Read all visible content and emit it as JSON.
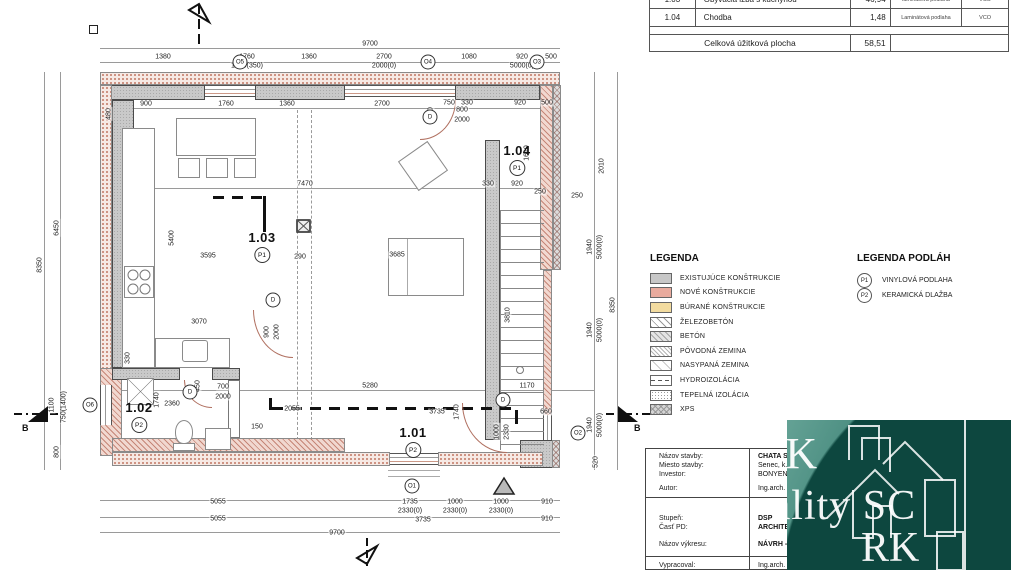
{
  "table": {
    "rows": [
      {
        "id": "1.03",
        "name": "Obývacia izba s kuchyňou",
        "area": "46,94",
        "floor": "laminátová podlaha",
        "code": "VCO"
      },
      {
        "id": "1.04",
        "name": "Chodba",
        "area": "1,48",
        "floor": "Laminátová podlaha",
        "code": "VCO"
      }
    ],
    "total_label": "Celková úžitková plocha",
    "total_value": "58,51"
  },
  "legend": {
    "title": "LEGENDA",
    "items": [
      {
        "label": "EXISTUJÚCE KONŠTRUKCIE"
      },
      {
        "label": "NOVÉ KONŠTRUKCIE"
      },
      {
        "label": "BÚRANÉ KONŠTRUKCIE"
      },
      {
        "label": "ŽELEZOBETÓN"
      },
      {
        "label": "BETÓN"
      },
      {
        "label": "PÔVODNÁ ZEMINA"
      },
      {
        "label": "NASYPANÁ ZEMINA"
      },
      {
        "label": "HYDROIZOLÁCIA"
      },
      {
        "label": "TEPELNÁ IZOLÁCIA"
      },
      {
        "label": "XPS"
      }
    ]
  },
  "floor_legend": {
    "title": "LEGENDA PODLÁH",
    "items": [
      {
        "tag": "P1",
        "label": "VINYLOVÁ PODLAHA"
      },
      {
        "tag": "P2",
        "label": "KERAMICKÁ DLAŽBA"
      }
    ]
  },
  "titleblock": {
    "rows": [
      {
        "label": "Názov stavby:",
        "value": "CHATA SE"
      },
      {
        "label": "Miesto stavby:",
        "value": "Senec, k.ú."
      },
      {
        "label": "Investor:",
        "value": "BONYEN,"
      },
      {
        "label": "Autor:",
        "value": "Ing.arch. K"
      },
      {
        "label": "Stupeň:",
        "value": "DSP"
      },
      {
        "label": "Časť PD:",
        "value": "ARCHITEK"
      },
      {
        "label": "Názov výkresu:",
        "value": "NÁVRH - P"
      },
      {
        "label": "Vypracoval:",
        "value": "Ing.arch. K"
      }
    ]
  },
  "watermark": {
    "lines": [
      "RK",
      "Reality SC",
      "RK"
    ],
    "teal_light": "#64a295",
    "teal_dark": "#124f47"
  },
  "plan": {
    "section_label": "B",
    "rooms": [
      {
        "id": "1.03",
        "tag": "P1",
        "x": 262,
        "y": 230
      },
      {
        "id": "1.04",
        "tag": "P1",
        "x": 517,
        "y": 143
      },
      {
        "id": "1.02",
        "tag": "P2",
        "x": 139,
        "y": 400
      },
      {
        "id": "1.01",
        "tag": "P2",
        "x": 413,
        "y": 425
      }
    ],
    "markers": [
      {
        "t": "O5",
        "x": 240,
        "y": 62
      },
      {
        "t": "O4",
        "x": 428,
        "y": 62
      },
      {
        "t": "O3",
        "x": 537,
        "y": 62
      },
      {
        "t": "O6",
        "x": 90,
        "y": 405
      },
      {
        "t": "O2",
        "x": 578,
        "y": 433
      },
      {
        "t": "O1",
        "x": 412,
        "y": 486
      },
      {
        "t": "D",
        "x": 430,
        "y": 117
      },
      {
        "t": "D",
        "x": 273,
        "y": 300
      },
      {
        "t": "D",
        "x": 190,
        "y": 392
      },
      {
        "t": "D",
        "x": 503,
        "y": 400
      }
    ],
    "dimensions": [
      {
        "t": "9700",
        "x": 370,
        "y": 44
      },
      {
        "t": "1380",
        "x": 163,
        "y": 57
      },
      {
        "t": "1760",
        "x": 247,
        "y": 57
      },
      {
        "t": "1650(350)",
        "x": 247,
        "y": 66
      },
      {
        "t": "1360",
        "x": 309,
        "y": 57
      },
      {
        "t": "2700",
        "x": 384,
        "y": 57
      },
      {
        "t": "2000(0)",
        "x": 384,
        "y": 66
      },
      {
        "t": "1080",
        "x": 469,
        "y": 57
      },
      {
        "t": "920",
        "x": 522,
        "y": 57
      },
      {
        "t": "5000(0)",
        "x": 522,
        "y": 66
      },
      {
        "t": "500",
        "x": 551,
        "y": 57
      },
      {
        "t": "480",
        "x": 109,
        "y": 114,
        "v": 1
      },
      {
        "t": "900",
        "x": 146,
        "y": 104
      },
      {
        "t": "1760",
        "x": 226,
        "y": 104
      },
      {
        "t": "1360",
        "x": 287,
        "y": 104
      },
      {
        "t": "2700",
        "x": 382,
        "y": 104
      },
      {
        "t": "500",
        "x": 431,
        "y": 113,
        "v": 1
      },
      {
        "t": "750",
        "x": 449,
        "y": 103
      },
      {
        "t": "330",
        "x": 467,
        "y": 103
      },
      {
        "t": "920",
        "x": 520,
        "y": 103
      },
      {
        "t": "500",
        "x": 547,
        "y": 103
      },
      {
        "t": "800",
        "x": 462,
        "y": 110
      },
      {
        "t": "2000",
        "x": 462,
        "y": 120
      },
      {
        "t": "1610",
        "x": 527,
        "y": 153,
        "v": 1
      },
      {
        "t": "8350",
        "x": 40,
        "y": 265,
        "v": 1
      },
      {
        "t": "6450",
        "x": 57,
        "y": 228,
        "v": 1
      },
      {
        "t": "1100",
        "x": 52,
        "y": 405,
        "v": 1
      },
      {
        "t": "750(1400)",
        "x": 64,
        "y": 407,
        "v": 1
      },
      {
        "t": "800",
        "x": 57,
        "y": 452,
        "v": 1
      },
      {
        "t": "2010",
        "x": 602,
        "y": 166,
        "v": 1
      },
      {
        "t": "1940",
        "x": 590,
        "y": 247,
        "v": 1
      },
      {
        "t": "5000(0)",
        "x": 600,
        "y": 247,
        "v": 1
      },
      {
        "t": "8350",
        "x": 613,
        "y": 305,
        "v": 1
      },
      {
        "t": "1940",
        "x": 590,
        "y": 330,
        "v": 1
      },
      {
        "t": "5000(0)",
        "x": 600,
        "y": 330,
        "v": 1
      },
      {
        "t": "1940",
        "x": 590,
        "y": 425,
        "v": 1
      },
      {
        "t": "5000(0)",
        "x": 600,
        "y": 425,
        "v": 1
      },
      {
        "t": "520",
        "x": 596,
        "y": 462,
        "v": 1
      },
      {
        "t": "250",
        "x": 540,
        "y": 192
      },
      {
        "t": "250",
        "x": 577,
        "y": 196
      },
      {
        "t": "7470",
        "x": 305,
        "y": 184
      },
      {
        "t": "5400",
        "x": 172,
        "y": 238,
        "v": 1
      },
      {
        "t": "3595",
        "x": 208,
        "y": 256
      },
      {
        "t": "290",
        "x": 300,
        "y": 257
      },
      {
        "t": "3070",
        "x": 199,
        "y": 322
      },
      {
        "t": "330",
        "x": 128,
        "y": 358,
        "v": 1
      },
      {
        "t": "3685",
        "x": 397,
        "y": 255
      },
      {
        "t": "900",
        "x": 267,
        "y": 332,
        "v": 1
      },
      {
        "t": "2000",
        "x": 277,
        "y": 332,
        "v": 1
      },
      {
        "t": "330",
        "x": 488,
        "y": 184
      },
      {
        "t": "920",
        "x": 517,
        "y": 184
      },
      {
        "t": "3810",
        "x": 508,
        "y": 315,
        "v": 1
      },
      {
        "t": "700",
        "x": 223,
        "y": 387
      },
      {
        "t": "2000",
        "x": 223,
        "y": 397
      },
      {
        "t": "450",
        "x": 198,
        "y": 386,
        "v": 1
      },
      {
        "t": "2360",
        "x": 172,
        "y": 404
      },
      {
        "t": "1740",
        "x": 157,
        "y": 400,
        "v": 1
      },
      {
        "t": "150",
        "x": 257,
        "y": 427
      },
      {
        "t": "2055",
        "x": 292,
        "y": 409
      },
      {
        "t": "5280",
        "x": 370,
        "y": 386
      },
      {
        "t": "3735",
        "x": 437,
        "y": 412
      },
      {
        "t": "1740",
        "x": 457,
        "y": 412,
        "v": 1
      },
      {
        "t": "1170",
        "x": 527,
        "y": 386
      },
      {
        "t": "660",
        "x": 546,
        "y": 412
      },
      {
        "t": "1000",
        "x": 497,
        "y": 432,
        "v": 1
      },
      {
        "t": "2330",
        "x": 507,
        "y": 432,
        "v": 1
      },
      {
        "t": "5055",
        "x": 218,
        "y": 502
      },
      {
        "t": "1735",
        "x": 410,
        "y": 502
      },
      {
        "t": "2330(0)",
        "x": 410,
        "y": 511
      },
      {
        "t": "1000",
        "x": 455,
        "y": 502
      },
      {
        "t": "2330(0)",
        "x": 455,
        "y": 511
      },
      {
        "t": "1000",
        "x": 501,
        "y": 502
      },
      {
        "t": "2330(0)",
        "x": 501,
        "y": 511
      },
      {
        "t": "910",
        "x": 547,
        "y": 502
      },
      {
        "t": "5055",
        "x": 218,
        "y": 519
      },
      {
        "t": "3735",
        "x": 423,
        "y": 520
      },
      {
        "t": "910",
        "x": 547,
        "y": 519
      },
      {
        "t": "9700",
        "x": 337,
        "y": 533
      }
    ]
  }
}
